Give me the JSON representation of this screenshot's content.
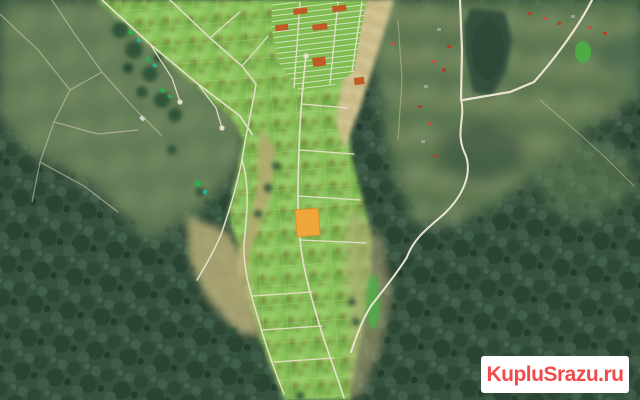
{
  "meta": {
    "view": "satellite-map",
    "description": "Aerial photo of a forested area with a cottage-settlement land-plot layout; one plot is highlighted in orange-yellow and several plots are marked red-orange; watermarked real-estate listing image"
  },
  "watermark": {
    "text": "KupluSrazu.ru",
    "bg_color": "#ffffff",
    "text_color": "#ef4b4b"
  },
  "colors": {
    "forest": "#36523f",
    "rural_northwest": "#66805a",
    "rural_east": "#627e55",
    "plot_band_green": "#86bf57",
    "tan_field": "#c2b57e",
    "pond": "#354f3e",
    "road_main": "#e9e5d2",
    "road_settlement": "#e4e0c8",
    "road_faint": "#c9c4a6",
    "highlighted_plot": "#f0a53a",
    "reserved_plot": "#c05a27",
    "red_roof": "#a8452f",
    "green_roof": "#2fae4e"
  },
  "map": {
    "highlighted_plot_label": "selected-land-plot",
    "reserved_plot_count": 6,
    "features": [
      "forest",
      "northwest-rural-area",
      "east-rural-area",
      "pond",
      "settlement-plot-band",
      "strip-plot-grid",
      "roads",
      "tan-fallow-strips",
      "houses"
    ]
  }
}
